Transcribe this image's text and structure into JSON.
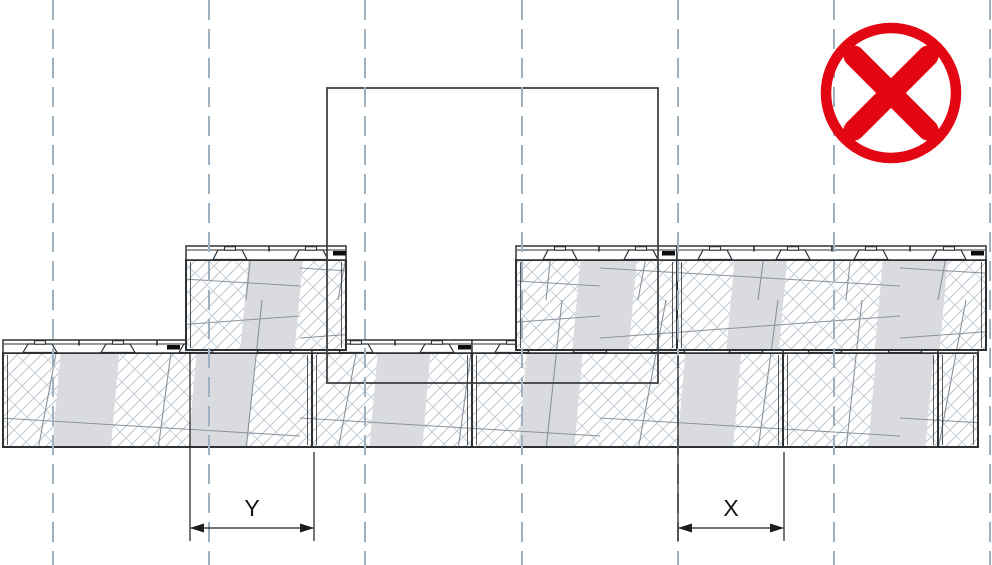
{
  "canvas": {
    "width": 992,
    "height": 565,
    "background": "#ffffff"
  },
  "colors": {
    "outline": "#2e3134",
    "rim_fill": "#ffffff",
    "hatch": "#bdc6d0",
    "hatch_back": "#cdd4dc",
    "mesh": "#8b929b",
    "band": "#d9dbde",
    "grid_dash": "#9db1c0",
    "dimension": "#1c1c1c",
    "anchor_mark": "#0c0d0e",
    "ghost_outline": "#3f4245",
    "prohibition_red": "#e30613"
  },
  "grid": {
    "xs": [
      53,
      209,
      365,
      522,
      678,
      834,
      990
    ],
    "dash": "20 9",
    "stroke_width": 2
  },
  "ghost_block": {
    "x": 327,
    "y": 88,
    "width": 331,
    "height": 295
  },
  "courses": {
    "lower": {
      "rim_top": 340,
      "rim_bottom": 353,
      "body_bottom": 447,
      "blocks": [
        {
          "x": 3,
          "width": 309,
          "knobs": [
            37,
            115,
            193,
            271
          ],
          "anchor": 164,
          "bands": [
            [
              0.16,
              0.35
            ],
            [
              0.6,
              0.79
            ]
          ]
        },
        {
          "x": 312,
          "width": 160,
          "knobs": [
            44,
            125
          ],
          "anchor": 146,
          "bands": [
            [
              0.36,
              0.69
            ]
          ]
        },
        {
          "x": 472,
          "width": 311,
          "knobs": [
            40,
            118,
            196,
            274
          ],
          "bands": [
            [
              0.15,
              0.33
            ],
            [
              0.66,
              0.84
            ]
          ]
        },
        {
          "x": 783,
          "width": 155,
          "knobs": [
            42,
            122
          ],
          "bands": [
            [
              0.55,
              0.92
            ]
          ]
        },
        {
          "x": 938,
          "width": 40,
          "knobs": [],
          "bands": []
        }
      ]
    },
    "upper": {
      "rim_top": 246,
      "rim_bottom": 260,
      "body_bottom": 350,
      "blocks": [
        {
          "x": 186,
          "width": 160,
          "knobs": [
            44,
            125
          ],
          "anchor": 147,
          "bands": [
            [
              0.34,
              0.68
            ]
          ]
        },
        {
          "x": 516,
          "width": 161,
          "knobs": [
            44,
            125
          ],
          "anchor": 146,
          "bands": [
            [
              0.35,
              0.7
            ]
          ]
        },
        {
          "x": 677,
          "width": 309,
          "knobs": [
            38,
            116,
            194,
            272
          ],
          "anchor": 294,
          "bands": [
            [
              0.16,
              0.33
            ],
            [
              0.64,
              0.85
            ]
          ]
        }
      ]
    }
  },
  "dimensions": {
    "y": {
      "label": "Y",
      "x1": 190,
      "x2": 314,
      "line_y": 528,
      "ext1_top": 352,
      "ext2_top": 452,
      "ext_bottom": 541
    },
    "x": {
      "label": "X",
      "x1": 678,
      "x2": 784,
      "line_y": 528,
      "ext1_top": 356,
      "ext2_top": 452,
      "ext_bottom": 541
    }
  },
  "prohibition_icon": {
    "glyph": "circled-cross",
    "cx": 891,
    "cy": 93,
    "ring_radius": 65,
    "ring_width": 10.5,
    "cross_half": 37,
    "cross_width": 21
  }
}
